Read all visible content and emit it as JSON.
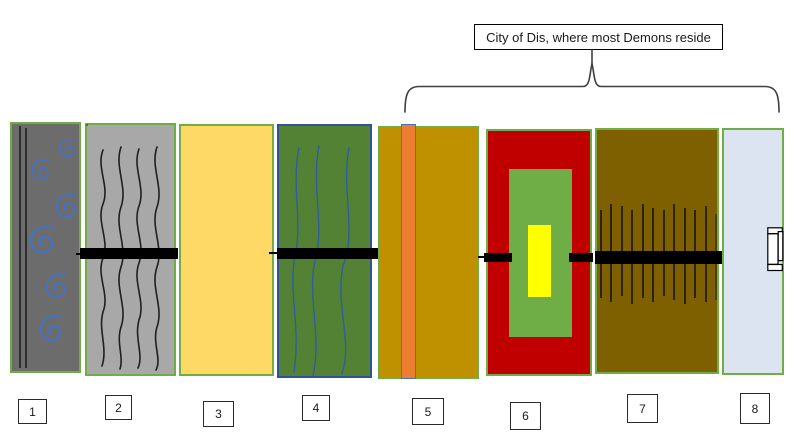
{
  "annotation": {
    "label": "City of Dis, where most Demons reside"
  },
  "circles": [
    {
      "number": "1",
      "fill": "#6C6C6C",
      "border": "#70AD47",
      "motif": "blue-spirals-with-two-vertical-lines"
    },
    {
      "number": "2",
      "fill": "#A8A8A8",
      "border": "#70AD47",
      "motif": "black-wavy-vertical-lines"
    },
    {
      "number": "3",
      "fill": "#FFD966",
      "border": "#70AD47",
      "motif": "plain"
    },
    {
      "number": "4",
      "fill": "#548235",
      "border": "#2E5496",
      "motif": "blue-wavy-vertical-lines"
    },
    {
      "number": "5",
      "fill": "#BF9000",
      "border": "#70AD47",
      "motif": "orange-vertical-stripe"
    },
    {
      "number": "6",
      "fill": "#C00000",
      "border": "#70AD47",
      "motif": "nested-green-and-yellow-rectangles"
    },
    {
      "number": "7",
      "fill": "#7F6000",
      "border": "#70AD47",
      "motif": "vertical-spikes"
    },
    {
      "number": "8",
      "fill": "#DCE4F2",
      "border": "#70AD47",
      "motif": "gate-shape"
    }
  ],
  "colors": {
    "bar": "#000000",
    "brace": "#3F3F3F",
    "spiral_blue": "#4472C4",
    "line_black": "#1F1F1F",
    "wave_blue": "#2F5D9E",
    "spike": "#151515",
    "stripe_fill": "#ED7D31",
    "stripe_border": "#4472C4",
    "inner_green": "#6FAD47",
    "inner_yellow": "#FFFF00",
    "gate_fill": "#FFFFFF",
    "gate_border": "#000000",
    "background": "#FFFFFF"
  }
}
